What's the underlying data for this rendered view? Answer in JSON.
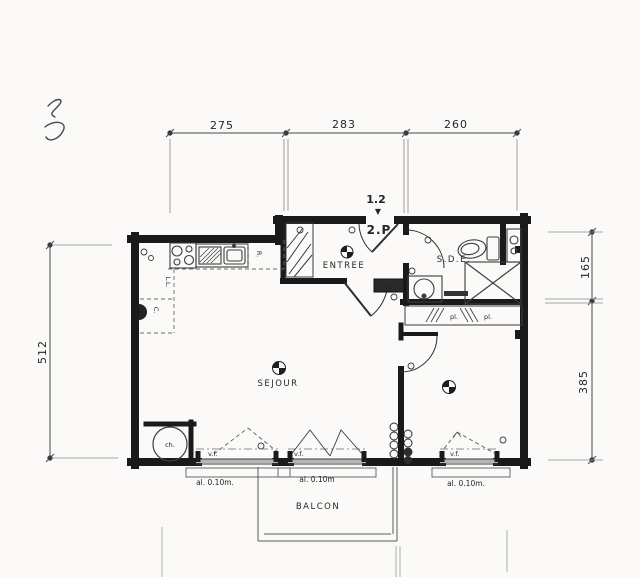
{
  "colors": {
    "paper": "#fbfaf8",
    "wall": "#1a1a1a",
    "line": "#3c3c3c",
    "dimline": "#4a4a4a",
    "faint": "#8a8a8a",
    "sill_fill": "#b5b5b5"
  },
  "dims": {
    "top": [
      "275",
      "283",
      "260"
    ],
    "left": "512",
    "right": [
      "165",
      "385"
    ]
  },
  "marker": {
    "l1": "1.2",
    "arrow": "▼",
    "l2": "2.P"
  },
  "rooms": {
    "entree": "ENTREE",
    "sde": "S.D.E.",
    "sejour": "SEJOUR",
    "balcon": "BALCON"
  },
  "fixtures": {
    "fridge": "R.",
    "washer": "L.L.",
    "cupboard": "C.",
    "heater": "ch.",
    "panel": "edf",
    "pl1": "pl.",
    "pl2": "pl."
  },
  "windows": {
    "vf": [
      "v.f.",
      "v.f.",
      "v.f."
    ],
    "sills": [
      "al. 0.10m.",
      "al. 0.10m",
      "al. 0.10m."
    ]
  }
}
